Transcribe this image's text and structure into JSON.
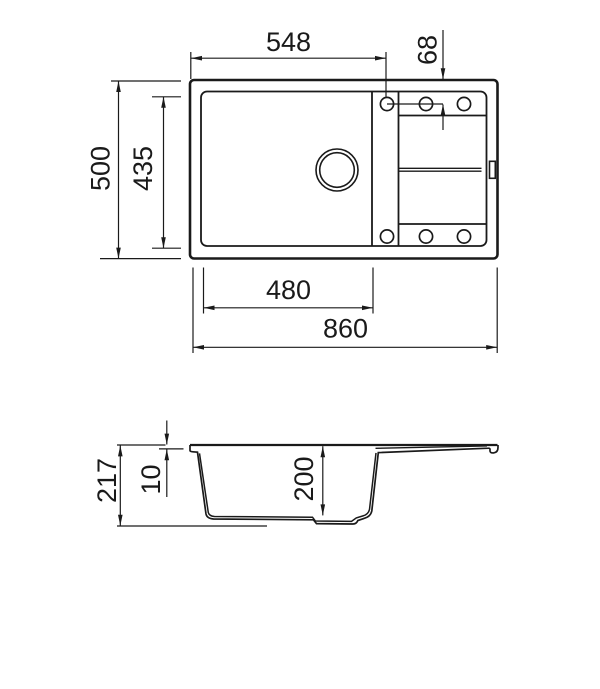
{
  "drawing": {
    "dims": {
      "top_width": "548",
      "tap_offset": "68",
      "overall_depth": "500",
      "bowl_inner_depth": "435",
      "bowl_width": "480",
      "overall_width": "860",
      "overall_height": "217",
      "rim_height": "10",
      "bowl_depth": "200"
    }
  }
}
